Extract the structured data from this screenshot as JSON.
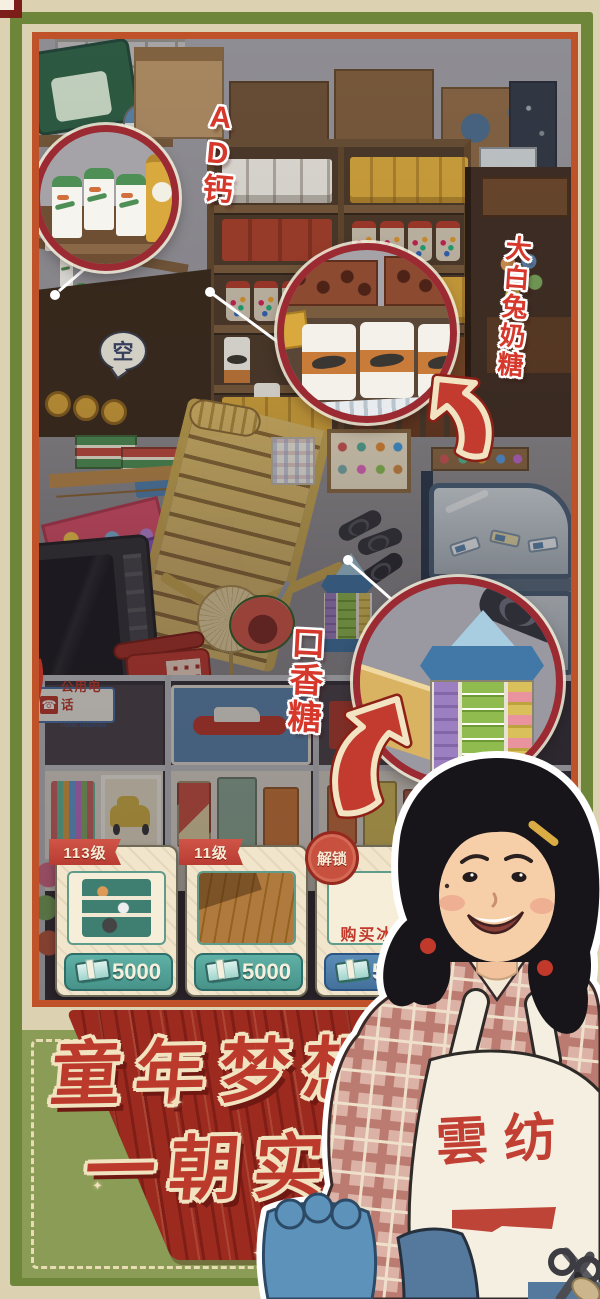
{
  "callouts": {
    "ad_calcium_label": "AD钙",
    "white_rabbit_label": "大白兔奶糖",
    "gum_label": "口香糖"
  },
  "scene": {
    "empty_bubble": "空",
    "phone_sign_cn": "公用电话",
    "phone_sign_en": "Public Telephone"
  },
  "cards": [
    {
      "level": "113级",
      "price": "5000"
    },
    {
      "level": "11级",
      "price": "5000"
    },
    {
      "badge": "解锁",
      "action": "购买冰箱",
      "price": "5000"
    }
  ],
  "banner": {
    "line1": "童年梦想",
    "line2": "一朝实现"
  },
  "character": {
    "apron_text": "雲纺"
  },
  "decor": {
    "sparkle": "✦",
    "phone_icon": "☎"
  },
  "colors": {
    "frame_green": "#6d8639",
    "scene_border": "#bf5229",
    "highlight_ring": "#9b2a33",
    "banner_red": "#9d2a1f",
    "price_teal": "#53a29a",
    "price_blue": "#4d7dab"
  }
}
